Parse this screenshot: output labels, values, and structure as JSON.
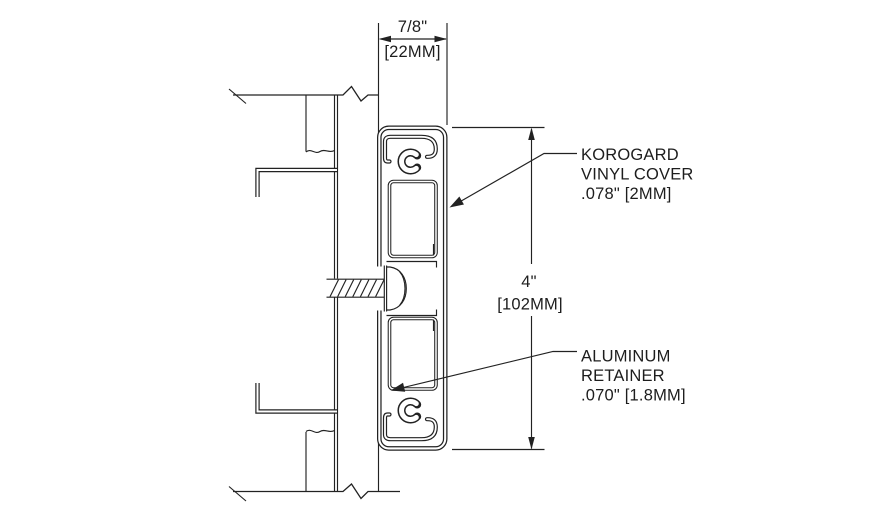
{
  "drawing": {
    "dim_width": {
      "value": "7/8\"",
      "metric": "[22MM]"
    },
    "dim_height": {
      "value": "4\"",
      "metric": "[102MM]"
    },
    "callout_cover": {
      "line1": "KOROGARD",
      "line2": "VINYL COVER",
      "line3": ".078\" [2MM]"
    },
    "callout_retainer": {
      "line1": "ALUMINUM",
      "line2": "RETAINER",
      "line3": ".070\" [1.8MM]"
    }
  },
  "colors": {
    "line": "#222222",
    "background": "#ffffff"
  }
}
